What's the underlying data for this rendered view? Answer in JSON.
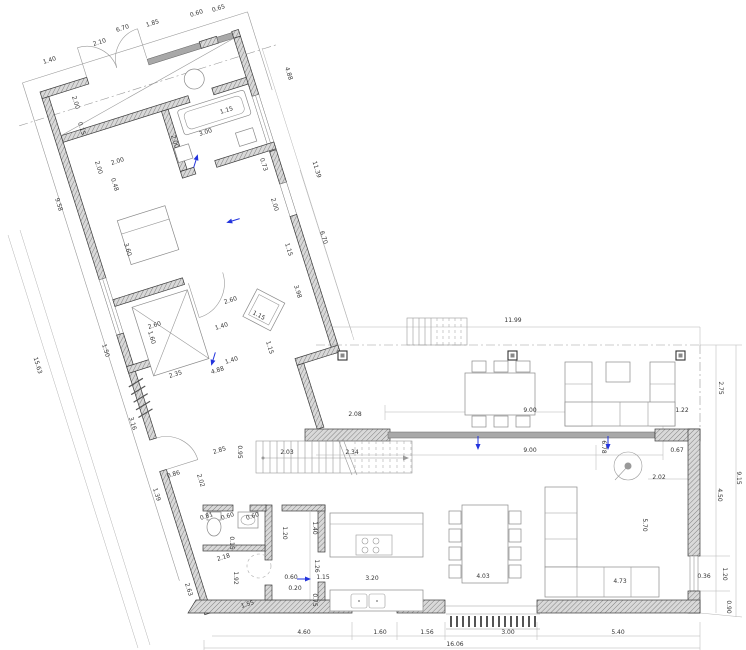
{
  "drawing": {
    "type": "architectural-floor-plan",
    "units": "meters",
    "overall_width_label": "16.06",
    "overall_right_height_label": "9.15"
  },
  "colors": {
    "wall_fill": "#d9d9d9",
    "wall_hatch": "#808080",
    "wall_edge": "#3a3a3a",
    "glass": "#a8a8a8",
    "thin_line": "#999999",
    "dim_text": "#333333",
    "accent_blue": "#2233dd",
    "background": "#ffffff"
  },
  "dimensions": [
    {
      "t": "1.40",
      "x": 50,
      "y": 62,
      "r": -17
    },
    {
      "t": "2.10",
      "x": 100,
      "y": 44,
      "r": -17
    },
    {
      "t": "6.70",
      "x": 123,
      "y": 30,
      "r": -17
    },
    {
      "t": "1.85",
      "x": 153,
      "y": 25,
      "r": -17
    },
    {
      "t": "0.60",
      "x": 197,
      "y": 15,
      "r": -17
    },
    {
      "t": "0.65",
      "x": 219,
      "y": 10,
      "r": -17
    },
    {
      "t": "9.58",
      "x": 57,
      "y": 205,
      "r": 73
    },
    {
      "t": "15.63",
      "x": 36,
      "y": 366,
      "r": 73
    },
    {
      "t": "1.50",
      "x": 104,
      "y": 351,
      "r": 73
    },
    {
      "t": "3.16",
      "x": 131,
      "y": 424,
      "r": 73
    },
    {
      "t": "2.63",
      "x": 187,
      "y": 590,
      "r": 73
    },
    {
      "t": "4.88",
      "x": 287,
      "y": 74,
      "r": 73
    },
    {
      "t": "11.39",
      "x": 315,
      "y": 170,
      "r": 73
    },
    {
      "t": "6.70",
      "x": 322,
      "y": 238,
      "r": 73
    },
    {
      "t": "0.73",
      "x": 262,
      "y": 165,
      "r": 73
    },
    {
      "t": "2.00",
      "x": 273,
      "y": 205,
      "r": 73
    },
    {
      "t": "1.15",
      "x": 287,
      "y": 250,
      "r": 73
    },
    {
      "t": "3.98",
      "x": 296,
      "y": 292,
      "r": 73
    },
    {
      "t": "1.15",
      "x": 227,
      "y": 112,
      "r": -17
    },
    {
      "t": "3.00",
      "x": 206,
      "y": 134,
      "r": -17
    },
    {
      "t": "2.00",
      "x": 118,
      "y": 163,
      "r": -17
    },
    {
      "t": "2.60",
      "x": 155,
      "y": 327,
      "r": -17
    },
    {
      "t": "2.60",
      "x": 231,
      "y": 302,
      "r": -17
    },
    {
      "t": "1.40",
      "x": 222,
      "y": 328,
      "r": -17
    },
    {
      "t": "1.40",
      "x": 232,
      "y": 362,
      "r": -17
    },
    {
      "t": "2.35",
      "x": 176,
      "y": 376,
      "r": -17
    },
    {
      "t": "4.88",
      "x": 218,
      "y": 372,
      "r": -17
    },
    {
      "t": "2.85",
      "x": 220,
      "y": 452,
      "r": -17
    },
    {
      "t": "0.86",
      "x": 174,
      "y": 476,
      "r": -17
    },
    {
      "t": "2.18",
      "x": 224,
      "y": 559,
      "r": -17
    },
    {
      "t": "1.55",
      "x": 248,
      "y": 606,
      "r": -17
    },
    {
      "t": "0.81",
      "x": 207,
      "y": 518,
      "r": -17
    },
    {
      "t": "0.60",
      "x": 228,
      "y": 518,
      "r": -17
    },
    {
      "t": "0.60",
      "x": 253,
      "y": 518,
      "r": -17
    },
    {
      "t": "2.00",
      "x": 74,
      "y": 103,
      "r": 73
    },
    {
      "t": "0.15",
      "x": 80,
      "y": 129,
      "r": 73
    },
    {
      "t": "2.00",
      "x": 173,
      "y": 142,
      "r": 73
    },
    {
      "t": "2.00",
      "x": 97,
      "y": 168,
      "r": 73
    },
    {
      "t": "0.48",
      "x": 113,
      "y": 185,
      "r": 73
    },
    {
      "t": "3.60",
      "x": 126,
      "y": 250,
      "r": 73
    },
    {
      "t": "1.60",
      "x": 150,
      "y": 338,
      "r": 73
    },
    {
      "t": "2.02",
      "x": 199,
      "y": 481,
      "r": 73
    },
    {
      "t": "1.39",
      "x": 155,
      "y": 495,
      "r": 73
    },
    {
      "t": "1.15",
      "x": 268,
      "y": 348,
      "r": 73
    },
    {
      "t": "1.15",
      "x": 258,
      "y": 317,
      "r": 28
    },
    {
      "t": "2.03",
      "x": 287,
      "y": 454,
      "r": 0
    },
    {
      "t": "2.34",
      "x": 352,
      "y": 454,
      "r": 0
    },
    {
      "t": "2.08",
      "x": 355,
      "y": 416,
      "r": 0
    },
    {
      "t": "0.95",
      "x": 238,
      "y": 452,
      "r": 90
    },
    {
      "t": "0.15",
      "x": 230,
      "y": 543,
      "r": 90
    },
    {
      "t": "1.92",
      "x": 234,
      "y": 578,
      "r": 90
    },
    {
      "t": "1.20",
      "x": 283,
      "y": 533,
      "r": 90
    },
    {
      "t": "1.40",
      "x": 313,
      "y": 528,
      "r": 90
    },
    {
      "t": "1.26",
      "x": 315,
      "y": 566,
      "r": 90
    },
    {
      "t": "0.75",
      "x": 313,
      "y": 600,
      "r": 90
    },
    {
      "t": "0.60",
      "x": 291,
      "y": 579,
      "r": 0
    },
    {
      "t": "1.15",
      "x": 323,
      "y": 579,
      "r": 0
    },
    {
      "t": "0.20",
      "x": 295,
      "y": 590,
      "r": 0
    },
    {
      "t": "11.99",
      "x": 513,
      "y": 322,
      "r": 0
    },
    {
      "t": "9.00",
      "x": 530,
      "y": 412,
      "r": 0
    },
    {
      "t": "1.22",
      "x": 682,
      "y": 412,
      "r": 0
    },
    {
      "t": "9.00",
      "x": 530,
      "y": 452,
      "r": 0
    },
    {
      "t": "0.67",
      "x": 677,
      "y": 452,
      "r": 0
    },
    {
      "t": "2.02",
      "x": 659,
      "y": 479,
      "r": 0
    },
    {
      "t": "4.73",
      "x": 620,
      "y": 583,
      "r": 0
    },
    {
      "t": "3.20",
      "x": 372,
      "y": 580,
      "r": 0
    },
    {
      "t": "4.03",
      "x": 483,
      "y": 578,
      "r": 0
    },
    {
      "t": "4.60",
      "x": 304,
      "y": 634,
      "r": 0
    },
    {
      "t": "1.60",
      "x": 380,
      "y": 634,
      "r": 0
    },
    {
      "t": "1.56",
      "x": 427,
      "y": 634,
      "r": 0
    },
    {
      "t": "3.00",
      "x": 508,
      "y": 634,
      "r": 0
    },
    {
      "t": "5.40",
      "x": 618,
      "y": 634,
      "r": 0
    },
    {
      "t": "16.06",
      "x": 455,
      "y": 646,
      "r": 0
    },
    {
      "t": "0.36",
      "x": 704,
      "y": 578,
      "r": 0
    },
    {
      "t": "2.75",
      "x": 719,
      "y": 388,
      "r": 90
    },
    {
      "t": "6.78",
      "x": 602,
      "y": 447,
      "r": 90
    },
    {
      "t": "4.50",
      "x": 718,
      "y": 495,
      "r": 90
    },
    {
      "t": "9.15",
      "x": 737,
      "y": 478,
      "r": 90
    },
    {
      "t": "5.70",
      "x": 643,
      "y": 525,
      "r": 90
    },
    {
      "t": "1.20",
      "x": 723,
      "y": 574,
      "r": 90
    },
    {
      "t": "0.90",
      "x": 727,
      "y": 607,
      "r": 90
    }
  ],
  "arrows": [
    {
      "x": 305,
      "y": 579,
      "r": 0
    },
    {
      "x": 478,
      "y": 444,
      "r": 90
    },
    {
      "x": 608,
      "y": 444,
      "r": 90
    },
    {
      "x": 232,
      "y": 221,
      "r": 163
    },
    {
      "x": 196,
      "y": 160,
      "r": -73
    },
    {
      "x": 213,
      "y": 360,
      "r": 107
    }
  ]
}
